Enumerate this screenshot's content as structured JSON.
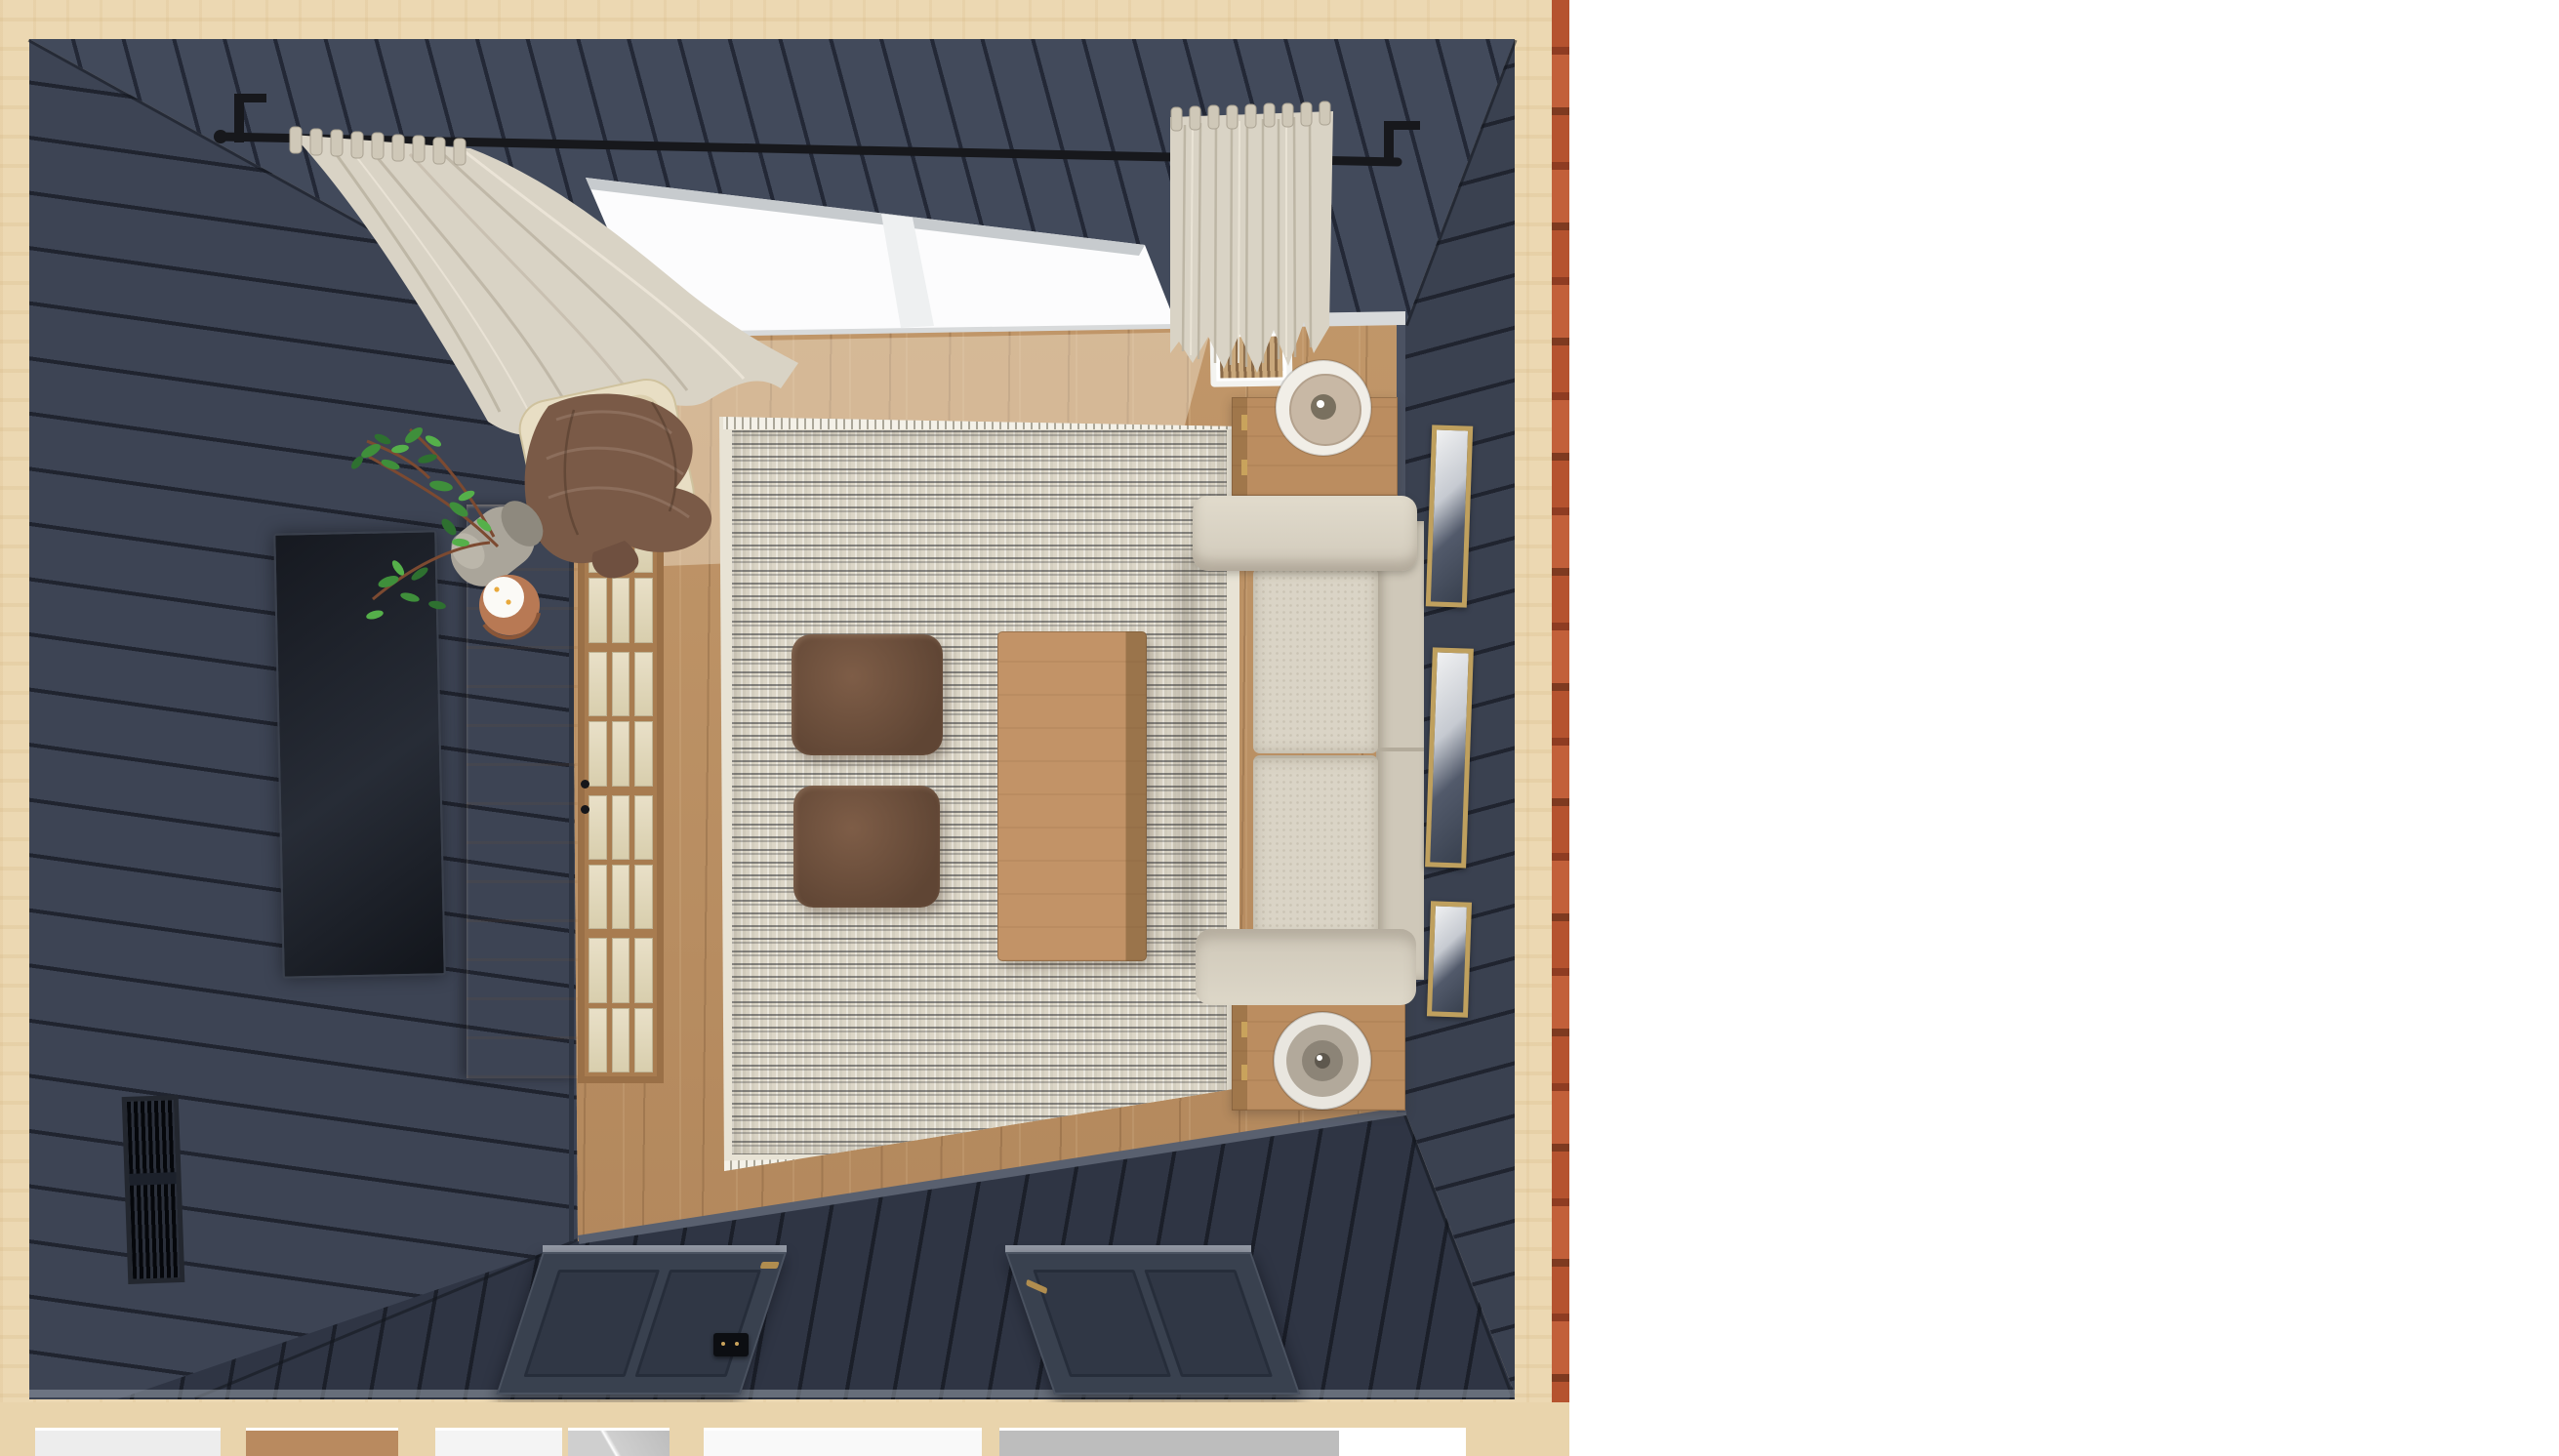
{
  "app": {
    "view_label": "3D top-down dollhouse render of a living room",
    "canvas_background": "#ffffff"
  },
  "palette": {
    "wall_navy": "#3d4454",
    "wall_plank_line": "#20242f",
    "floor_oak": "#bb8f63",
    "exterior_siding_tan": "#ecd8b2",
    "brick_edge_red": "#b5532f",
    "window_light": "#fcfcfd",
    "sill_gray": "#d8dadb",
    "curtain_cream": "#d9d3c5",
    "rod_black": "#17181c",
    "rug_cream": "#dcd6c7",
    "sofa_boucle": "#d8d2c4",
    "pouf_brown": "#6b4c39",
    "wood_furniture": "#bb8d60",
    "blanket_brown": "#7a5a47",
    "plant_green": "#3f8f3b",
    "frame_gold": "#bfa05e",
    "door_navy": "#39414f",
    "brass": "#b08d4f"
  },
  "scene": {
    "objects": {
      "viewport": {
        "label": "3D room viewport"
      },
      "exterior": {
        "label": "Exterior wood siding",
        "color": "#ecd8b2"
      },
      "brick": {
        "label": "Exterior brick edge",
        "color": "#b5532f"
      },
      "wall_top": {
        "label": "Top wall with window",
        "color": "#424a5b"
      },
      "wall_left": {
        "label": "Left media wall",
        "color": "#3d4454"
      },
      "wall_right": {
        "label": "Right gallery wall",
        "color": "#3a4150"
      },
      "wall_bottom": {
        "label": "Bottom wall with doors",
        "color": "#2f3544"
      },
      "floor": {
        "label": "Oak plank floor",
        "color": "#bb8f63"
      },
      "window": {
        "label": "Picture window",
        "color": "#fcfcfd"
      },
      "floor_vent": {
        "label": "Floor heat register",
        "color": "#ffffff"
      },
      "curtain_rod": {
        "label": "Black curtain rod",
        "color": "#17181c"
      },
      "curtain_left": {
        "label": "Left linen curtain panel",
        "color": "#d9d3c5"
      },
      "curtain_right": {
        "label": "Right linen curtain panel",
        "color": "#d9d3c5"
      },
      "accent_chair": {
        "label": "Curved oak accent chair",
        "color": "#e8dec4"
      },
      "blanket": {
        "label": "Brown throw blanket",
        "color": "#7a5a47"
      },
      "plant": {
        "label": "Potted branch plant",
        "color": "#3f8f3b"
      },
      "pot": {
        "label": "Concrete planter pot",
        "color": "#aaa59a"
      },
      "candle": {
        "label": "Candle on copper tray",
        "color": "#fbfaf6"
      },
      "media_console": {
        "label": "Wood media console",
        "color": "#bb8d60"
      },
      "glass_cabinet": {
        "label": "Glass-pane bookcase cabinet",
        "color": "#a87c50"
      },
      "tv": {
        "label": "Wall-mounted TV",
        "color": "#161920"
      },
      "wall_vent": {
        "label": "Wall return-air vent",
        "color": "#05070b"
      },
      "rug": {
        "label": "Textured cream area rug",
        "color": "#dcd6c7"
      },
      "pouf_top": {
        "label": "Brown leather pouf (upper)",
        "color": "#6b4c39"
      },
      "pouf_bottom": {
        "label": "Brown leather pouf (lower)",
        "color": "#6b4c39"
      },
      "coffee_table": {
        "label": "Oak coffee table",
        "color": "#c29367"
      },
      "sofa": {
        "label": "Cream boucle sofa",
        "color": "#d8d2c4"
      },
      "end_table_top": {
        "label": "Oak end table (upper)",
        "color": "#bb8d60"
      },
      "end_table_bottom": {
        "label": "Oak end table (lower)",
        "color": "#bb8d60"
      },
      "lamp_top": {
        "label": "Sculptural table lamp (upper)",
        "color": "#f1eee7"
      },
      "lamp_bottom": {
        "label": "Sculptural table lamp (lower)",
        "color": "#e9e6df"
      },
      "art_1": {
        "label": "Framed wall art 1",
        "color": "#bfa05e"
      },
      "art_2": {
        "label": "Framed wall art 2",
        "color": "#bfa05e"
      },
      "art_3": {
        "label": "Framed wall art 3",
        "color": "#bfa05e"
      },
      "door_left": {
        "label": "Navy interior door (left)",
        "color": "#39414f"
      },
      "door_right": {
        "label": "Navy interior door (right)",
        "color": "#39414f"
      },
      "floor_box": {
        "label": "Floor outlet box",
        "color": "#0c0e12"
      },
      "lower_floor": {
        "label": "Lower level rooms (partial dollhouse view)",
        "color": "#e9d4ac"
      }
    }
  }
}
